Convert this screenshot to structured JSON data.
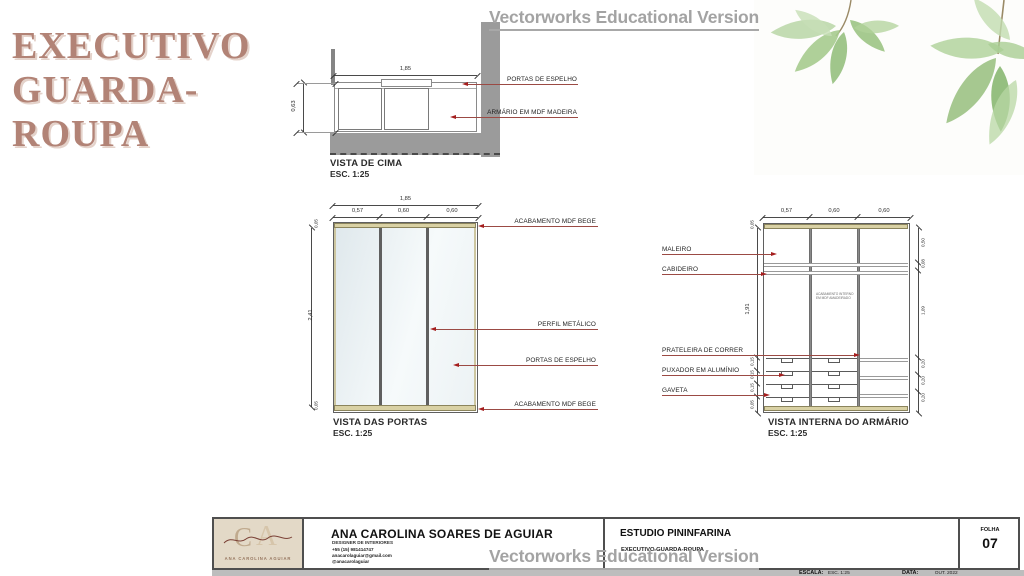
{
  "slide": {
    "title_lines": [
      "EXECUTIVO",
      "GUARDA-",
      "ROUPA"
    ]
  },
  "watermark": {
    "text": "Vectorworks Educational Version"
  },
  "colors": {
    "title": "#b28376",
    "leader_line": "#9b4a44",
    "arrow": "#a51e1e",
    "beige_mdf": "#d9d1a4",
    "wall_gray": "#9b9b9b",
    "watermark_gray": "#a3a3a3"
  },
  "top_view": {
    "caption": "VISTA DE CIMA",
    "scale": "ESC. 1:25",
    "dim_width": "1,85",
    "dim_depth": "0,63",
    "label_doors": "PORTAS DE ESPELHO",
    "label_cabinet": "ARMÁRIO EM MDF MADEIRA"
  },
  "doors_view": {
    "caption": "VISTA DAS PORTAS",
    "scale": "ESC. 1:25",
    "dim_total": "1,85",
    "dim_cols": [
      "0,57",
      "0,60",
      "0,60"
    ],
    "dim_top_strip": "0,05",
    "dim_height": "2,41",
    "dim_bottom_strip": "0,05",
    "label_top_finish": "ACABAMENTO MDF BEGE",
    "label_profile": "PERFIL METÁLICO",
    "label_mirror": "PORTAS DE ESPELHO",
    "label_bottom_finish": "ACABAMENTO MDF BEGE"
  },
  "internal_view": {
    "caption": "VISTA INTERNA DO ARMÁRIO",
    "scale": "ESC. 1:25",
    "dim_cols": [
      "0,57",
      "0,60",
      "0,60"
    ],
    "dim_top_strip": "0,05",
    "dim_height": "1,91",
    "dims_left_bottom": [
      "0,15",
      "0,15",
      "0,15",
      "0,05"
    ],
    "dims_right": [
      "0,50",
      "0,08",
      "1,09",
      "0,20",
      "0,20",
      "0,20"
    ],
    "label_maleiro": "MALEIRO",
    "label_cabideiro": "CABIDEIRO",
    "label_prateleira": "PRATELEIRA DE CORRER",
    "label_puxador": "PUXADOR EM ALUMÍNIO",
    "label_gaveta": "GAVETA",
    "note_lines": [
      "ACABAMENTO INTERNO",
      "EM MDF AMADEIRADO"
    ]
  },
  "titleblock": {
    "designer_name": "ANA CAROLINA SOARES DE AGUIAR",
    "designer_role": "DESIGNER DE INTERIORES",
    "phone": "+55 (15) 981414747",
    "email": "anacarolaguiar@gmail.com",
    "social": "@anacarolaguiar",
    "logo_initial_c": "C",
    "logo_initial_a": "A",
    "logo_name": "ANA CAROLINA AGUIAR",
    "studio": "ESTUDIO PININFARINA",
    "project": "EXECUTIVO GUARDA-ROUPA",
    "escala_label": "ESCALA:",
    "escala_value": "ESC. 1:25",
    "data_label": "DATA:",
    "data_value": "OUT. 2022",
    "folha_label": "FOLHA",
    "folha_value": "07"
  }
}
